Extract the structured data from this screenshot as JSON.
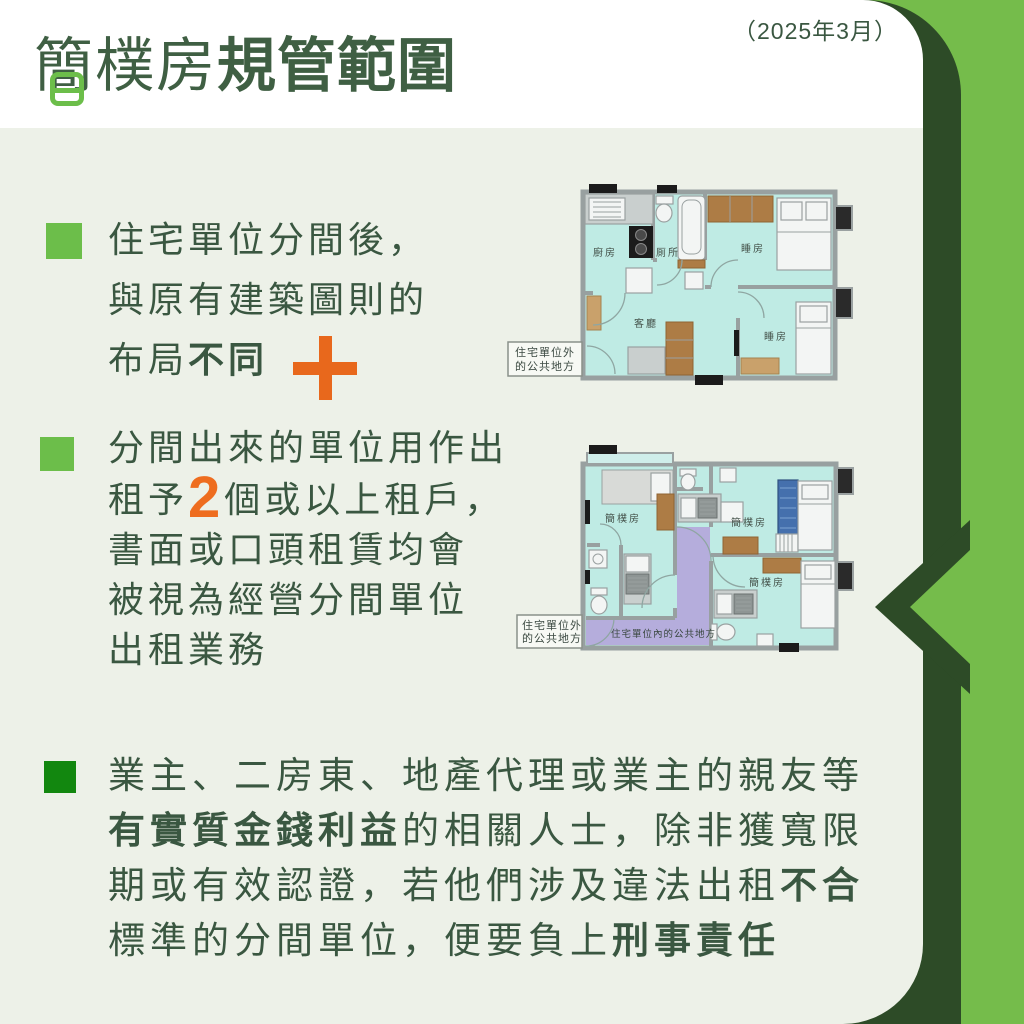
{
  "header": {
    "date": "（2025年3月）",
    "title_light": "簡樸房",
    "title_bold": "規管範圍"
  },
  "bullets": {
    "b1": {
      "pre": "住宅單位分間後，\n與原有建築圖則的\n布局",
      "bold": "不同"
    },
    "b2": {
      "pre": "分間出來的單位用作出\n租予",
      "highlight": "2",
      "post": "個或以上租戶，\n書面或口頭租賃均會\n被視為經營分間單位\n出租業務"
    },
    "b3": {
      "p1": "業主、二房東、地產代理或業主的親友等\n",
      "bold1": "有實質金錢利益",
      "p2": "的相關人士，除非獲寬限\n期或有效認證，若他們涉及違法出租",
      "bold2": "不合",
      "p3": "\n標準的分間單位，便要負上",
      "bold3": "刑事責任"
    }
  },
  "plan_top": {
    "kitchen": "廚房",
    "toilet": "厠所",
    "bedroom_top": "睡房",
    "living": "客廳",
    "bedroom_bottom": "睡房",
    "outside_l1": "住宅單位外",
    "outside_l2": "的公共地方"
  },
  "plan_bottom": {
    "room1": "簡樸房",
    "room2": "簡樸房",
    "room3": "簡樸房",
    "inside_common": "住宅單位內的公共地方",
    "outside_l1": "住宅單位外",
    "outside_l2": "的公共地方"
  },
  "colors": {
    "bright_green": "#75bc4b",
    "dark_green_stripe": "#2d4b27",
    "panel_bg": "#edf1e8",
    "text_green": "#3a5741",
    "bullet_green": "#6cbe4a",
    "bullet3_green": "#12870f",
    "accent_orange": "#e8681c",
    "room_cyan": "#bfebe4",
    "corridor_purple": "#b5addc"
  }
}
